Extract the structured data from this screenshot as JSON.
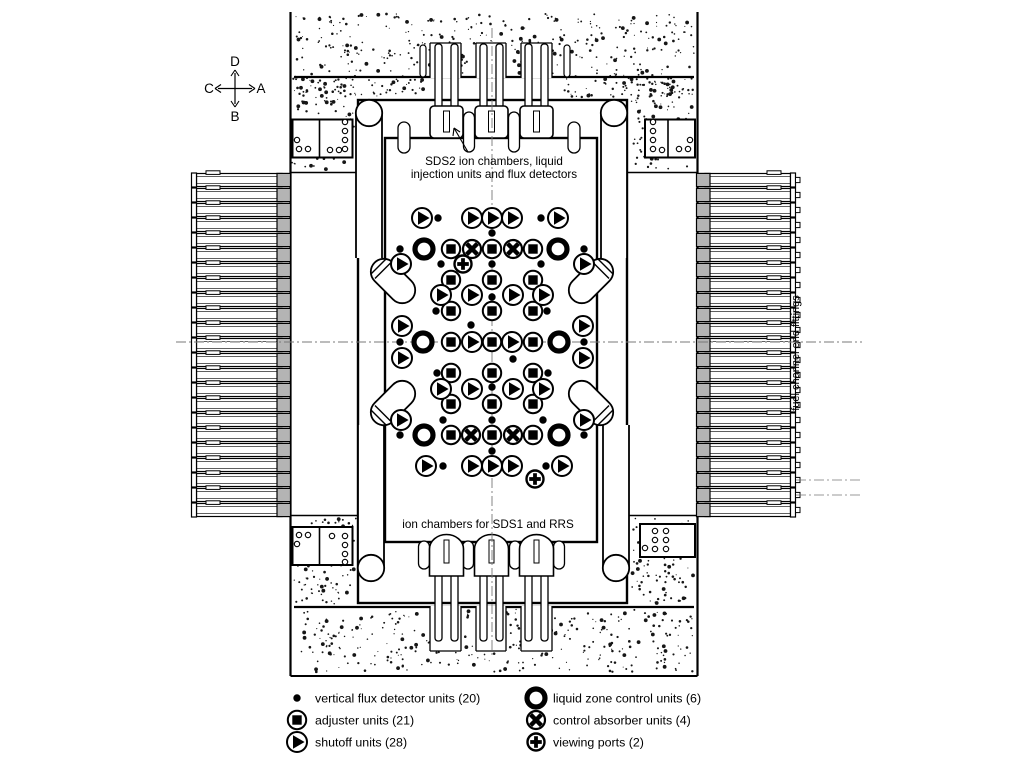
{
  "compass": {
    "up": "D",
    "down": "B",
    "left": "C",
    "right": "A"
  },
  "labels": {
    "top_line1": "SDS2 ion chambers, liquid",
    "top_line2": "injection units and flux detectors",
    "bottom": "ion chambers for SDS1 and RRS",
    "right_vertical": "fuel channel  end fittings"
  },
  "legend": {
    "left_column": [
      {
        "symbol": "flux-detector",
        "label": "vertical flux detector units (20)"
      },
      {
        "symbol": "adjuster",
        "label": "adjuster units (21)"
      },
      {
        "symbol": "shutoff",
        "label": "shutoff units (28)"
      }
    ],
    "right_column": [
      {
        "symbol": "liquid-zone",
        "label": "liquid zone control units (6)"
      },
      {
        "symbol": "control-absorber",
        "label": "control absorber units (4)"
      },
      {
        "symbol": "viewing-port",
        "label": "viewing ports (2)"
      }
    ]
  },
  "devices": {
    "flux_detector_units": [
      [
        438,
        218
      ],
      [
        541,
        218
      ],
      [
        492,
        233
      ],
      [
        400,
        249
      ],
      [
        584,
        249
      ],
      [
        441,
        264
      ],
      [
        492,
        264
      ],
      [
        541,
        264
      ],
      [
        492,
        297
      ],
      [
        436,
        311
      ],
      [
        547,
        311
      ],
      [
        471,
        325
      ],
      [
        400,
        342
      ],
      [
        584,
        342
      ],
      [
        513,
        359
      ],
      [
        437,
        373
      ],
      [
        548,
        373
      ],
      [
        492,
        387
      ],
      [
        443,
        420
      ],
      [
        492,
        420
      ],
      [
        543,
        420
      ],
      [
        400,
        435
      ],
      [
        584,
        435
      ],
      [
        443,
        466
      ],
      [
        492,
        451
      ],
      [
        546,
        466
      ]
    ],
    "adjuster_units": [
      [
        451,
        249
      ],
      [
        492,
        249
      ],
      [
        533,
        249
      ],
      [
        451,
        280
      ],
      [
        492,
        280
      ],
      [
        533,
        280
      ],
      [
        451,
        311
      ],
      [
        492,
        311
      ],
      [
        533,
        311
      ],
      [
        451,
        342
      ],
      [
        492,
        342
      ],
      [
        533,
        342
      ],
      [
        451,
        373
      ],
      [
        492,
        373
      ],
      [
        533,
        373
      ],
      [
        451,
        404
      ],
      [
        492,
        404
      ],
      [
        533,
        404
      ],
      [
        451,
        435
      ],
      [
        492,
        435
      ],
      [
        533,
        435
      ]
    ],
    "shutoff_units": [
      [
        422,
        218
      ],
      [
        472,
        218
      ],
      [
        492,
        218
      ],
      [
        512,
        218
      ],
      [
        558,
        218
      ],
      [
        401,
        264
      ],
      [
        584,
        264
      ],
      [
        441,
        295
      ],
      [
        472,
        295
      ],
      [
        513,
        295
      ],
      [
        543,
        295
      ],
      [
        402,
        326
      ],
      [
        583,
        326
      ],
      [
        472,
        342
      ],
      [
        512,
        342
      ],
      [
        402,
        358
      ],
      [
        583,
        358
      ],
      [
        441,
        389
      ],
      [
        472,
        389
      ],
      [
        513,
        389
      ],
      [
        543,
        389
      ],
      [
        401,
        420
      ],
      [
        584,
        420
      ],
      [
        426,
        466
      ],
      [
        472,
        466
      ],
      [
        492,
        466
      ],
      [
        512,
        466
      ],
      [
        562,
        466
      ]
    ],
    "liquid_zone_control_units": [
      [
        424,
        249
      ],
      [
        558,
        249
      ],
      [
        423,
        342
      ],
      [
        559,
        342
      ],
      [
        424,
        435
      ],
      [
        559,
        435
      ]
    ],
    "control_absorber_units": [
      [
        472,
        249
      ],
      [
        513,
        249
      ],
      [
        471,
        435
      ],
      [
        513,
        435
      ]
    ],
    "viewing_ports": [
      [
        463,
        264
      ],
      [
        535,
        479
      ]
    ]
  },
  "colors": {
    "ink": "#000000",
    "fitting_gray": "#b4b4b4",
    "centerline_gray": "#787878"
  }
}
